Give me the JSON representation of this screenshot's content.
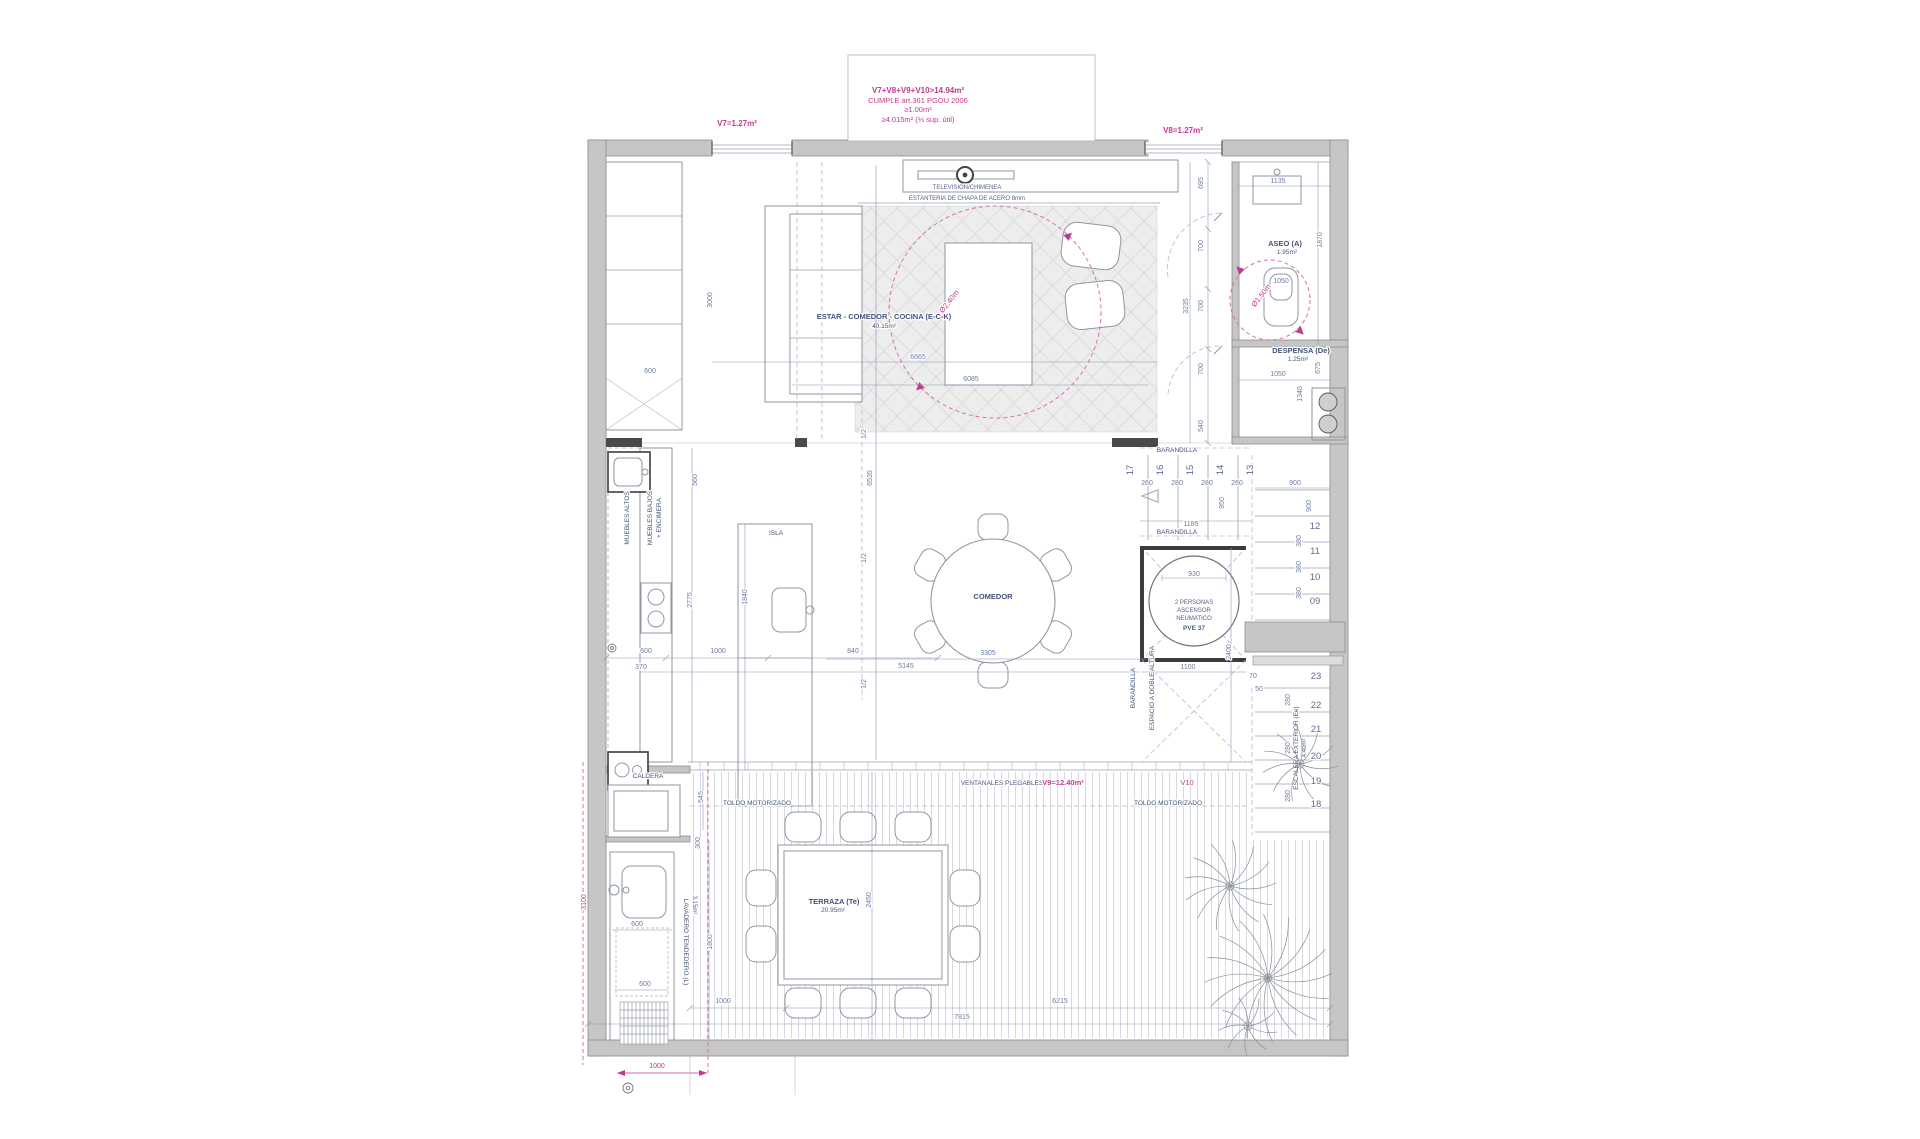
{
  "note": {
    "l1": "V7+V8+V9+V10>14.94m²",
    "l2": "CUMPLE art.361 PGOU 2006",
    "l3": "≥1.00m²",
    "l4": "≥4.015m² (⅓ sup. útil)"
  },
  "windows": {
    "v7": "V7=1.27m²",
    "v8": "V8=1.27m²",
    "v9": "V9=12.40m²",
    "v10": "V10"
  },
  "rooms": {
    "living": {
      "name": "ESTAR - COMEDOR - COCINA (E-C-K)",
      "area": "40.15m²"
    },
    "aseo": {
      "name": "ASEO (A)",
      "area": "1.95m²"
    },
    "despensa": {
      "name": "DESPENSA (De)",
      "area": "1.25m²"
    },
    "comedor": {
      "name": "COMEDOR"
    },
    "terraza": {
      "name": "TERRAZA (Te)",
      "area": "20.95m²"
    },
    "lavadero": {
      "name": "LAVADERO TENDEDERO (L)",
      "area": "3.15m²"
    },
    "escalera": {
      "name": "ESCALERA EXTERIOR (Ee)",
      "area": "4.40m²"
    },
    "doble_altura": {
      "name": "ESPACIO A DOBLE ALTURA"
    }
  },
  "furniture": {
    "television": "TELEVISION/CHIMENEA",
    "estanteria": "ESTANTERIA DE CHAPA DE ACERO 8mm",
    "muebles_altos": "MUEBLES ALTOS",
    "muebles_bajos": "MUEBLES BAJOS",
    "encimera": "+ ENCIMERA",
    "isla": "ISLA",
    "caldera": "CALDERA",
    "toldo_izq": "TOLDO MOTORIZADO",
    "toldo_der": "TOLDO MOTORIZADO",
    "ventanales": "VENTANALES PLEGABLES",
    "barandilla_sup": "BARANDILLA",
    "barandilla_inf": "BARANDILLA",
    "barandilla_vert": "BARANDILLA"
  },
  "elevator": {
    "l1": "2 PERSONAS",
    "l2": "ASCENSOR",
    "l3": "NEUMATICO",
    "l4": "PVE 37"
  },
  "circles": {
    "living": "Ø2.40m",
    "aseo": "Ø1.50m"
  },
  "colors": {
    "dim_blue": "#6d7ba2",
    "label_blue": "#44537a",
    "magenta": "#c2398f",
    "wall_gray": "#c6c6c6"
  },
  "dim_labels": [
    [
      712,
      300,
      "3000",
      -90,
      "b"
    ],
    [
      650,
      373,
      "600",
      0,
      "b"
    ],
    [
      918,
      359,
      "6665",
      0,
      "b"
    ],
    [
      971,
      381,
      "6085",
      0,
      "b"
    ],
    [
      872,
      478,
      "6535",
      -90,
      "b"
    ],
    [
      866,
      434,
      "1/2",
      -90,
      "b"
    ],
    [
      866,
      558,
      "1/2",
      -90,
      "b"
    ],
    [
      866,
      684,
      "1/2",
      -90,
      "b"
    ],
    [
      697,
      480,
      "560",
      -90,
      "b"
    ],
    [
      692,
      600,
      "2775",
      -90,
      "b"
    ],
    [
      747,
      597,
      "1840",
      -90,
      "b"
    ],
    [
      646,
      653,
      "600",
      0,
      "b"
    ],
    [
      641,
      669,
      "370",
      0,
      "b"
    ],
    [
      718,
      653,
      "1000",
      0,
      "b"
    ],
    [
      853,
      653,
      "840",
      0,
      "b"
    ],
    [
      906,
      668,
      "5145",
      0,
      "b"
    ],
    [
      988,
      655,
      "3305",
      0,
      "b"
    ],
    [
      1203,
      183,
      "695",
      -90,
      "b"
    ],
    [
      1203,
      246,
      "700",
      -90,
      "b"
    ],
    [
      1203,
      306,
      "700",
      -90,
      "b"
    ],
    [
      1203,
      369,
      "700",
      -90,
      "b"
    ],
    [
      1188,
      306,
      "3235",
      -90,
      "b"
    ],
    [
      1203,
      426,
      "540",
      -90,
      "b"
    ],
    [
      1278,
      183,
      "1135",
      0,
      "b"
    ],
    [
      1281,
      283,
      "1050",
      0,
      "b"
    ],
    [
      1322,
      240,
      "1870",
      -90,
      "b"
    ],
    [
      1278,
      376,
      "1050",
      0,
      "b"
    ],
    [
      1320,
      368,
      "675",
      -90,
      "b"
    ],
    [
      1302,
      394,
      "1340",
      -90,
      "b"
    ],
    [
      1147,
      485,
      "260",
      0,
      "b"
    ],
    [
      1177,
      485,
      "280",
      0,
      "b"
    ],
    [
      1207,
      485,
      "280",
      0,
      "b"
    ],
    [
      1237,
      485,
      "260",
      0,
      "b"
    ],
    [
      1295,
      485,
      "900",
      0,
      "b"
    ],
    [
      1311,
      506,
      "900",
      -90,
      "b"
    ],
    [
      1191,
      526,
      "1185",
      0,
      "b"
    ],
    [
      1224,
      503,
      "950",
      -90,
      "b"
    ],
    [
      1194,
      576,
      "930",
      0,
      "b"
    ],
    [
      1231,
      652,
      "2400",
      -90,
      "b"
    ],
    [
      1188,
      669,
      "1100",
      0,
      "b"
    ],
    [
      1253,
      678,
      "70",
      0,
      "b"
    ],
    [
      1259,
      691,
      "50",
      0,
      "b"
    ],
    [
      1301,
      541,
      "380",
      -90,
      "b"
    ],
    [
      1301,
      567,
      "380",
      -90,
      "b"
    ],
    [
      1301,
      593,
      "380",
      -90,
      "b"
    ],
    [
      1290,
      700,
      "280",
      -90,
      "b"
    ],
    [
      1290,
      748,
      "280",
      -90,
      "b"
    ],
    [
      1290,
      796,
      "280",
      -90,
      "b"
    ],
    [
      703,
      797,
      "545",
      -90,
      "b"
    ],
    [
      700,
      843,
      "300",
      -90,
      "b"
    ],
    [
      871,
      900,
      "2450",
      -90,
      "b"
    ],
    [
      637,
      926,
      "600",
      0,
      "b"
    ],
    [
      645,
      986,
      "600",
      0,
      "b"
    ],
    [
      712,
      942,
      "1800",
      -90,
      "b"
    ],
    [
      723,
      1003,
      "1000",
      0,
      "b"
    ],
    [
      1060,
      1003,
      "6215",
      0,
      "b"
    ],
    [
      962,
      1019,
      "7815",
      0,
      "b"
    ],
    [
      586,
      902,
      "3100",
      -90,
      "m"
    ],
    [
      657,
      1068,
      "1000",
      0,
      "m"
    ],
    [
      1133,
      470,
      "17",
      -90,
      "s"
    ],
    [
      1163,
      470,
      "16",
      -90,
      "s"
    ],
    [
      1193,
      470,
      "15",
      -90,
      "s"
    ],
    [
      1223,
      470,
      "14",
      -90,
      "s"
    ],
    [
      1253,
      470,
      "13",
      -90,
      "s"
    ],
    [
      1315,
      529,
      "12",
      0,
      "s"
    ],
    [
      1315,
      554,
      "11",
      0,
      "s"
    ],
    [
      1315,
      580,
      "10",
      0,
      "s"
    ],
    [
      1315,
      604,
      "09",
      0,
      "s"
    ],
    [
      1316,
      679,
      "23",
      0,
      "s"
    ],
    [
      1316,
      708,
      "22",
      0,
      "s"
    ],
    [
      1316,
      732,
      "21",
      0,
      "s"
    ],
    [
      1316,
      759,
      "20",
      0,
      "s"
    ],
    [
      1316,
      784,
      "19",
      0,
      "s"
    ],
    [
      1316,
      807,
      "18",
      0,
      "s"
    ]
  ]
}
